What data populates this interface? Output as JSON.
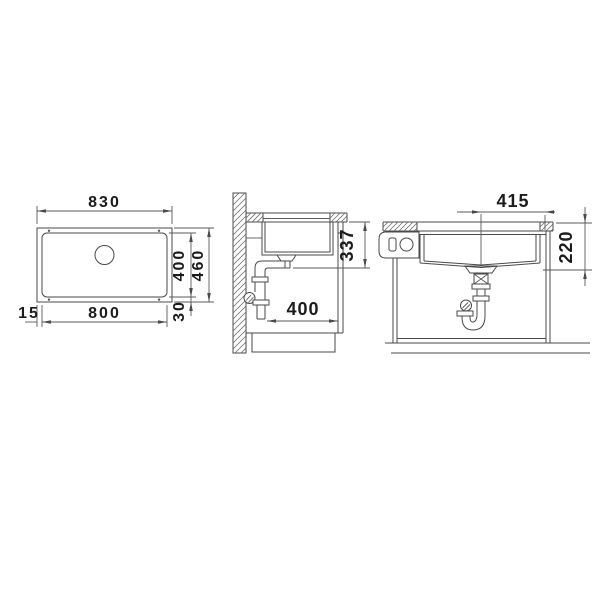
{
  "drawing": {
    "background": "#ffffff",
    "line_color": "#4a4a4a",
    "text_color": "#1c1c1c",
    "views": {
      "top_view": {
        "label": "sink top view",
        "dims": {
          "outer_width": "830",
          "bowl_height": "400",
          "outer_height": "460",
          "bowl_width": "800",
          "left_offset": "15",
          "bottom_offset": "30"
        }
      },
      "side_view": {
        "label": "side section view",
        "dims": {
          "underside_to_trap": "337",
          "pipe_to_front": "400"
        }
      },
      "front_view": {
        "label": "front section view",
        "dims": {
          "center_to_edge": "415",
          "top_to_bowl_bottom": "220"
        }
      }
    }
  }
}
